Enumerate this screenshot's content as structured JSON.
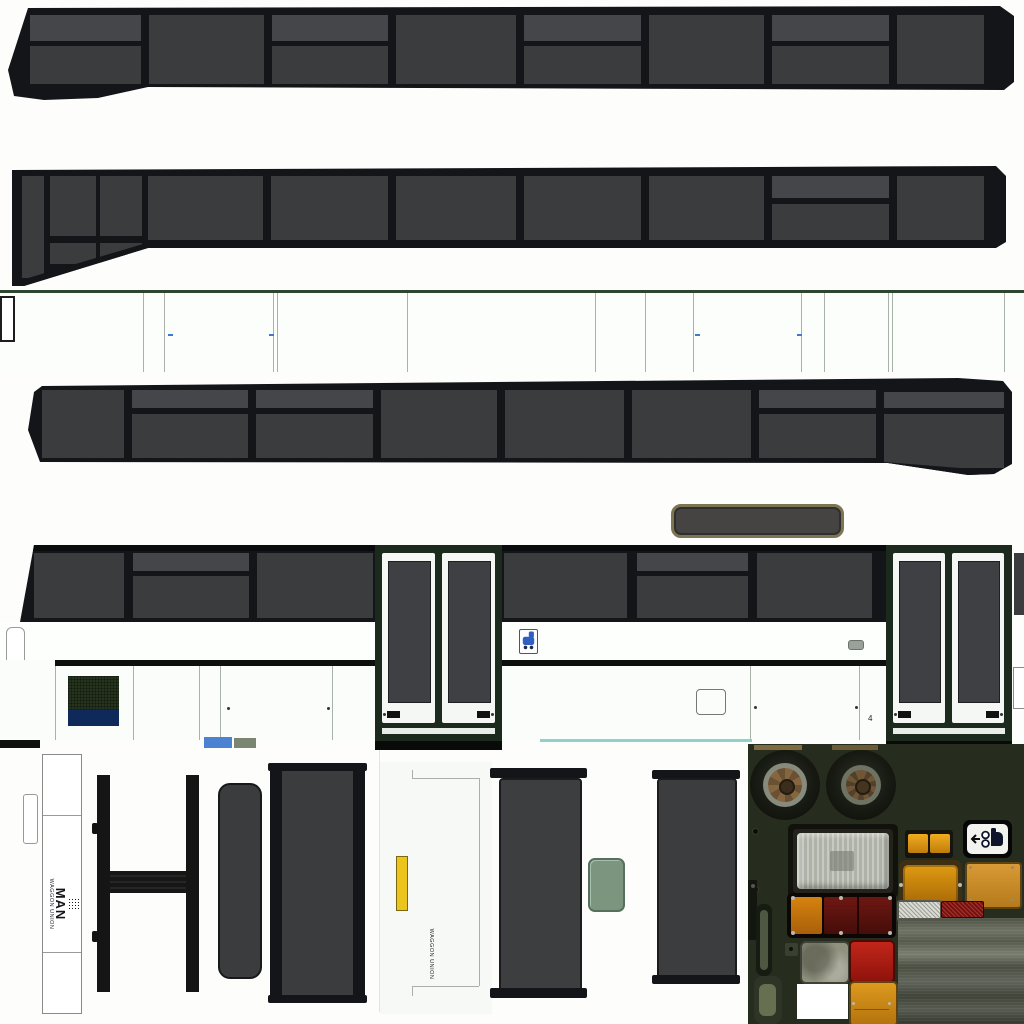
{
  "branding": {
    "man_logo": {
      "brand": "MAN",
      "subtitle": "WAGGON UNION"
    },
    "door_builder_label": "WAGGON UNION"
  },
  "markings": {
    "door_area_number": "4"
  },
  "icons": [
    "pram-icon",
    "arrow-left-icon",
    "pram-sticker-icon"
  ],
  "colors": {
    "frame_black": "#141518",
    "glass": "#3b3c3e",
    "glass_light": "#45464a",
    "seam_grey": "#a9b2a9",
    "body_white": "#fcfefc",
    "green_edge": "#2e4630",
    "door_frame_green": "#1b2a1d",
    "leaf_white": "#f4f7f3",
    "step_white": "#e9ede8",
    "grille_green": "#26331d",
    "grille_blue": "#0f2a5a",
    "teal_line": "#8fd2cd",
    "sticker_blue": "#2f5fc2",
    "accent_blue": "#4b83d2",
    "yellow_handle": "#ecc51c",
    "mirror_green": "#7c957f",
    "photo_bg": "#262d1e",
    "headlight_silver": "#c6cac0",
    "orange": "#d9920f",
    "tail_red": "#5e1210",
    "bright_red": "#b5201a",
    "reflector_white": "#dadcd3",
    "reflector_red": "#7c0f0b",
    "road_grey": "#565a4c",
    "rim_brown": "#84663f",
    "tire_black": "#14170f"
  }
}
